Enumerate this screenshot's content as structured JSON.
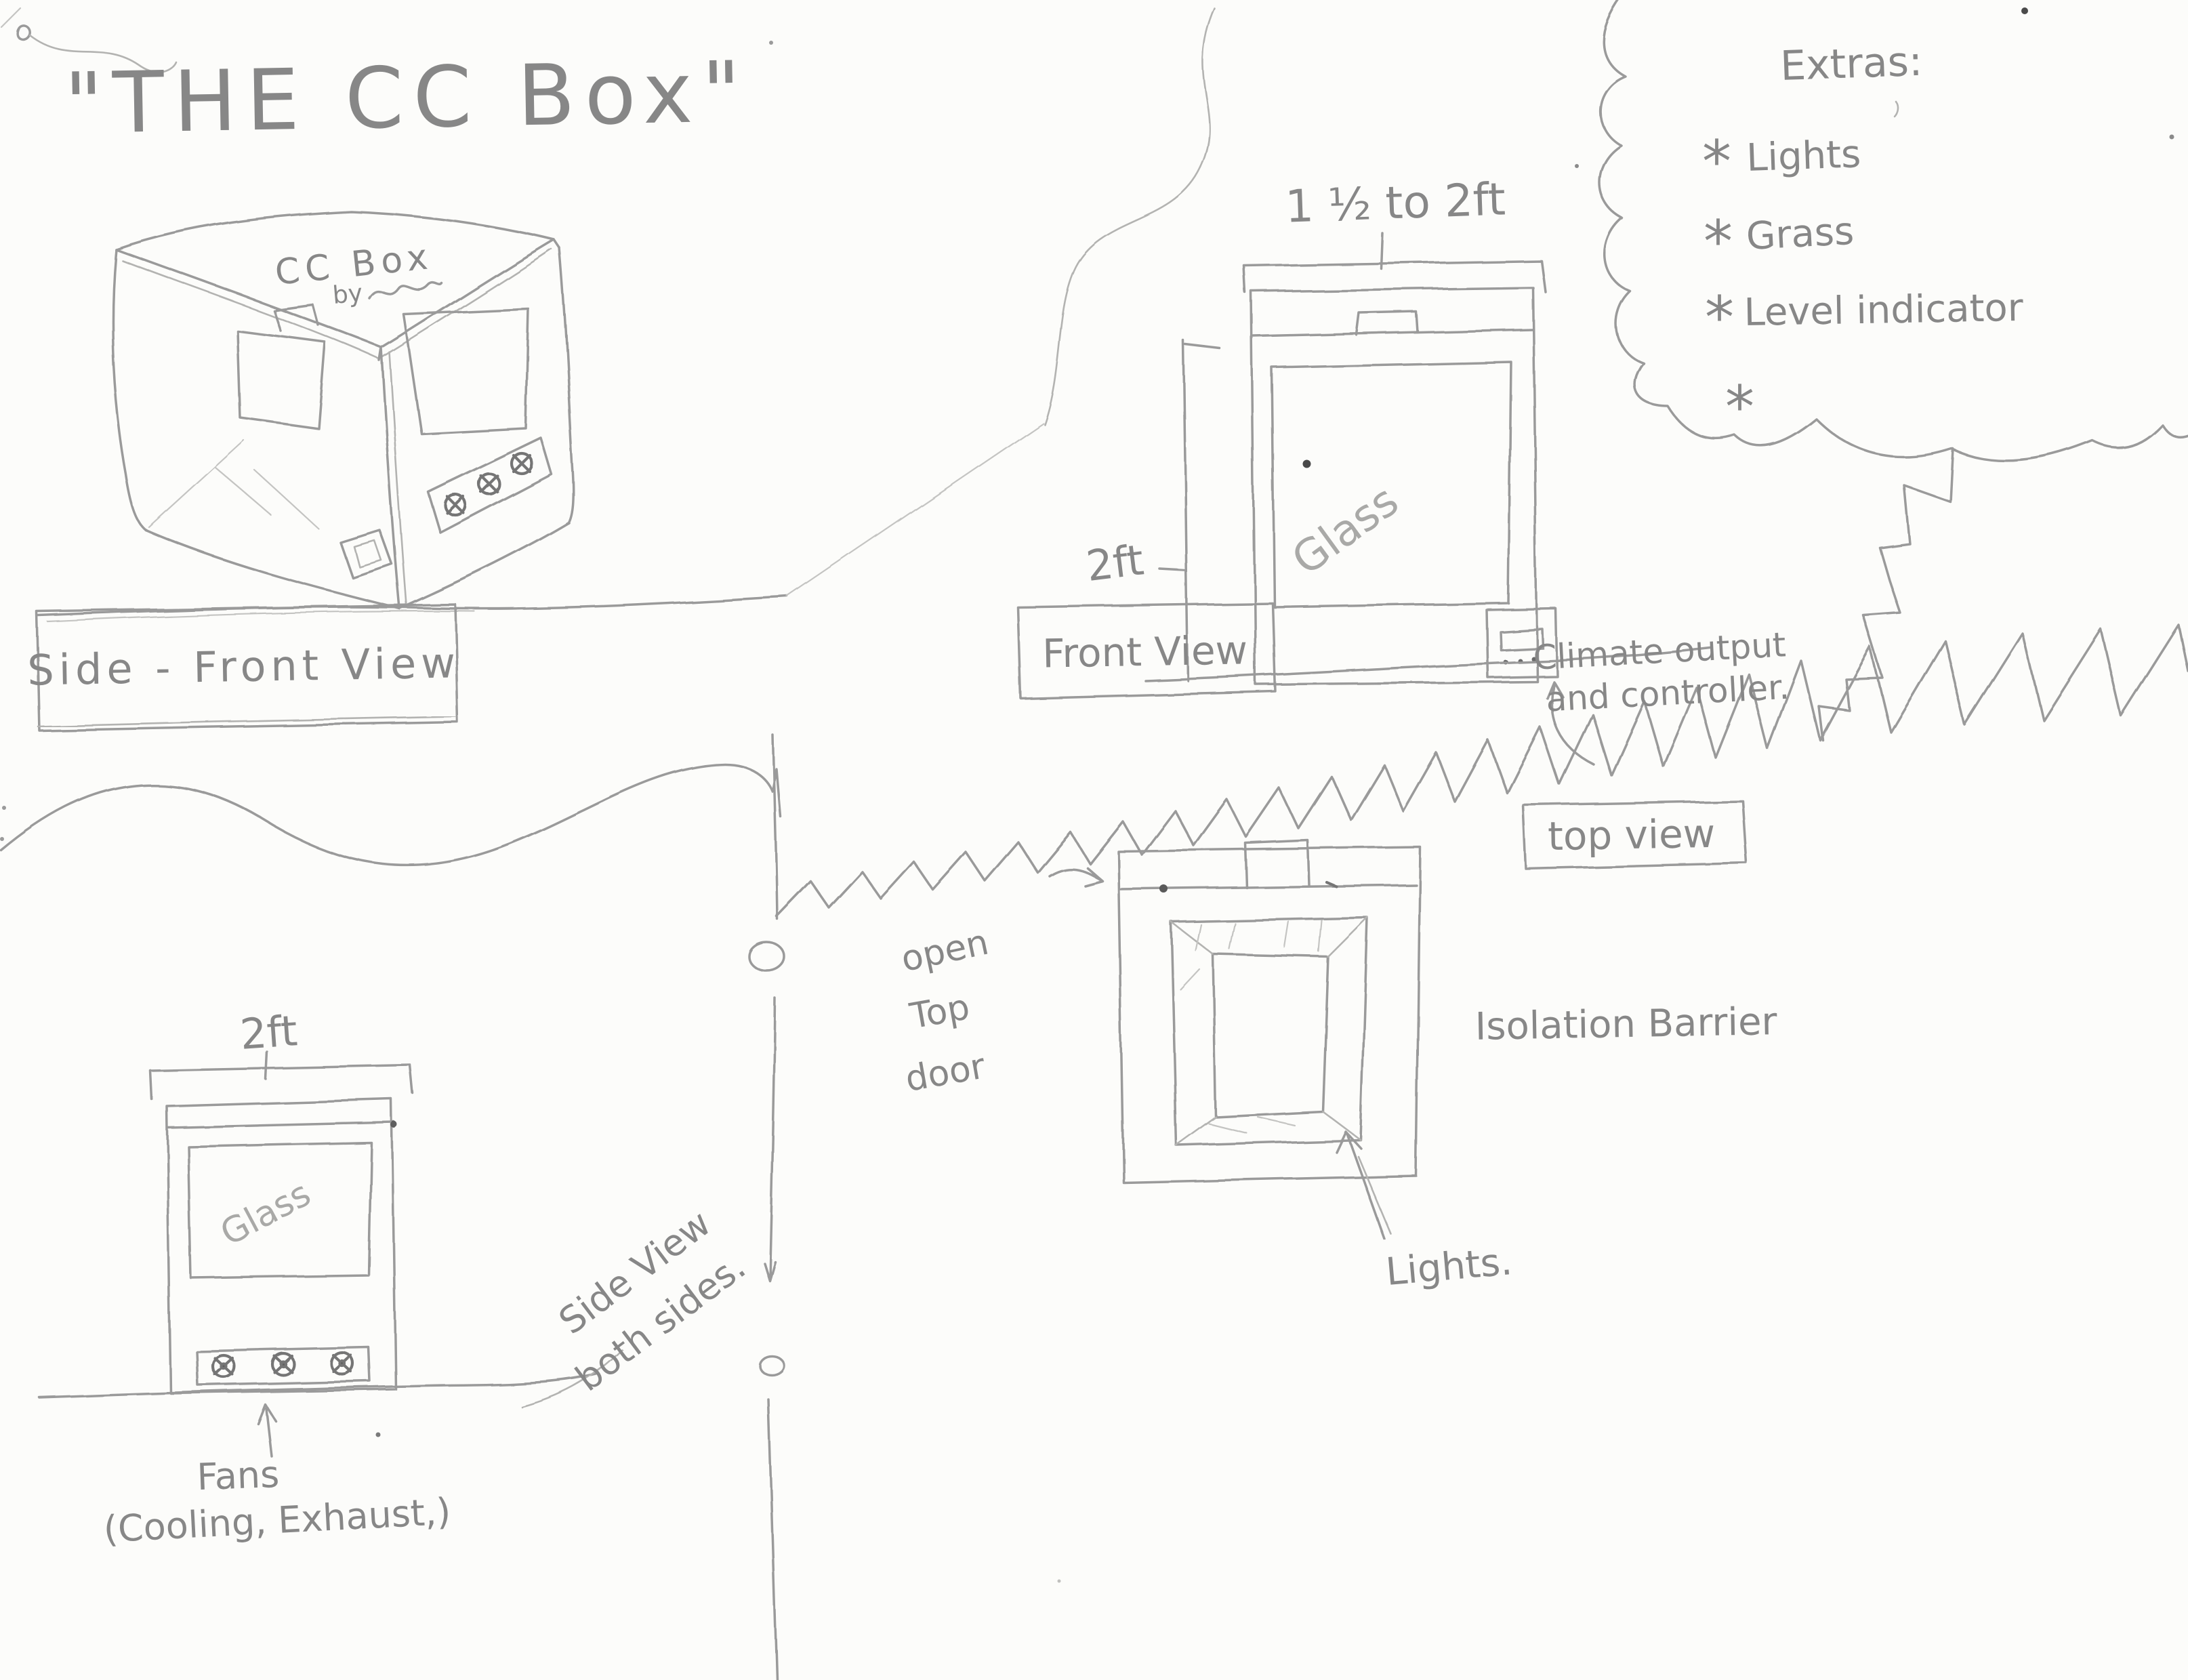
{
  "title": "\"THE CC Box\"",
  "extras": {
    "heading": "Extras:",
    "bullet": "*",
    "items": [
      "Lights",
      "Grass",
      "Level indicator",
      ""
    ]
  },
  "views": {
    "side_front": {
      "label": "Side - Front View",
      "object_title": "CC Box",
      "object_byline": "by"
    },
    "front": {
      "label": "Front View",
      "width_dim": "1 ½ to 2ft",
      "height_dim": "2ft",
      "glass_label": "Glass",
      "controller_note_line1": "Climate output",
      "controller_note_line2": "and controller."
    },
    "top": {
      "label": "top view",
      "barrier_note": "Isolation Barrier",
      "lights_note": "Lights.",
      "door_note_line1": "open",
      "door_note_line2": "Top",
      "door_note_line3": "door"
    },
    "side": {
      "label_line1": "Side View",
      "label_line2": "both sides.",
      "width_dim": "2ft",
      "glass_label": "Glass",
      "fans_note_line1": "Fans",
      "fans_note_line2": "(Cooling, Exhaust,)"
    }
  }
}
